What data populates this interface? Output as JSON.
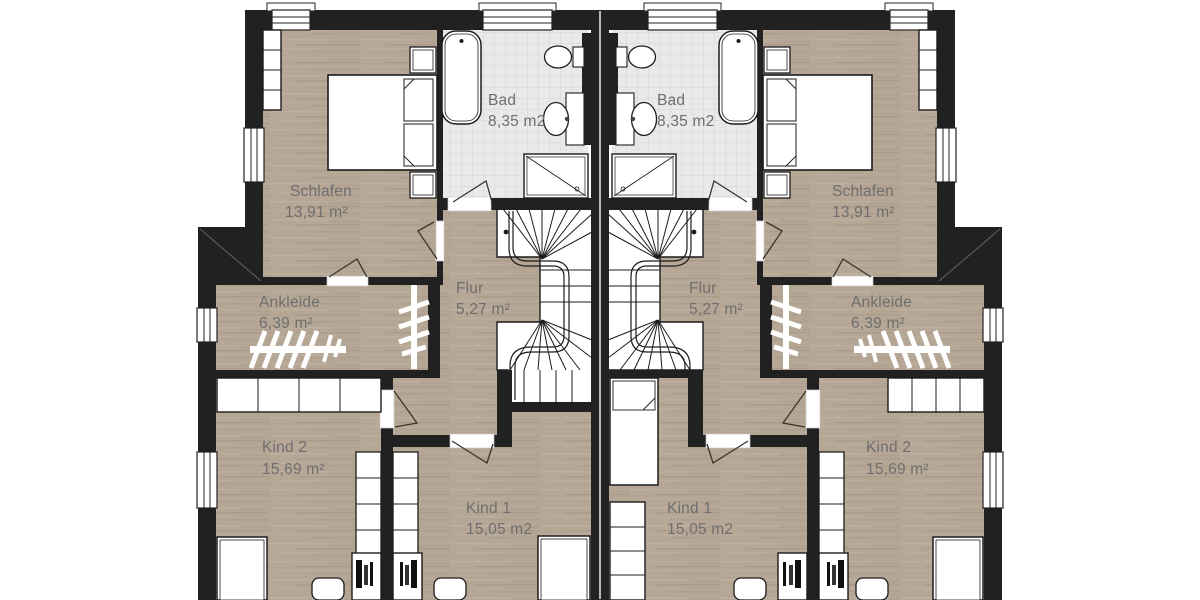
{
  "plan": {
    "rooms": {
      "schlafen": {
        "name": "Schlafen",
        "area": "13,91 m²"
      },
      "bad": {
        "name": "Bad",
        "area": "8,35 m2"
      },
      "ankleide": {
        "name": "Ankleide",
        "area": "6,39 m²"
      },
      "flur": {
        "name": "Flur",
        "area": "5,27 m²"
      },
      "kind1": {
        "name": "Kind 1",
        "area": "15,05 m2"
      },
      "kind2": {
        "name": "Kind 2",
        "area": "15,69 m²"
      }
    },
    "colors": {
      "wall": "#212121",
      "wood_floor": "#b5a695",
      "tile_floor": "#e9e9e9",
      "fixture_outline": "#1c1c1c",
      "label": "#6f6f6f"
    }
  }
}
